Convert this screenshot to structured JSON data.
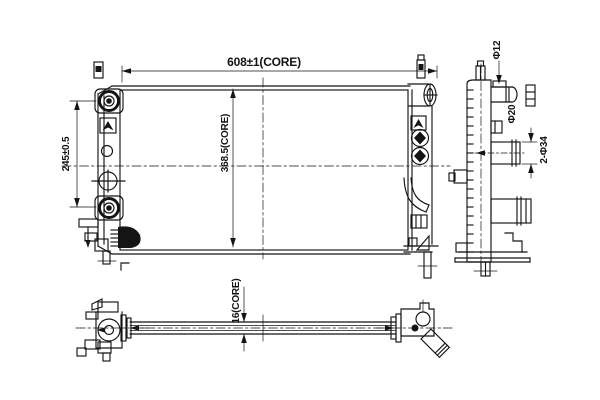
{
  "drawing": {
    "type": "radiator-orthographic-technical-drawing",
    "line_color": "#141414",
    "background_color": "#ffffff",
    "dimensions": {
      "core_width": "608±1(CORE)",
      "core_height": "368.5(CORE)",
      "port_spacing": "245±0.5",
      "core_thickness": "16(CORE)",
      "pipe_small": "Φ12",
      "pipe_mid": "Φ20",
      "pipes_pair": "2-Φ34"
    }
  }
}
